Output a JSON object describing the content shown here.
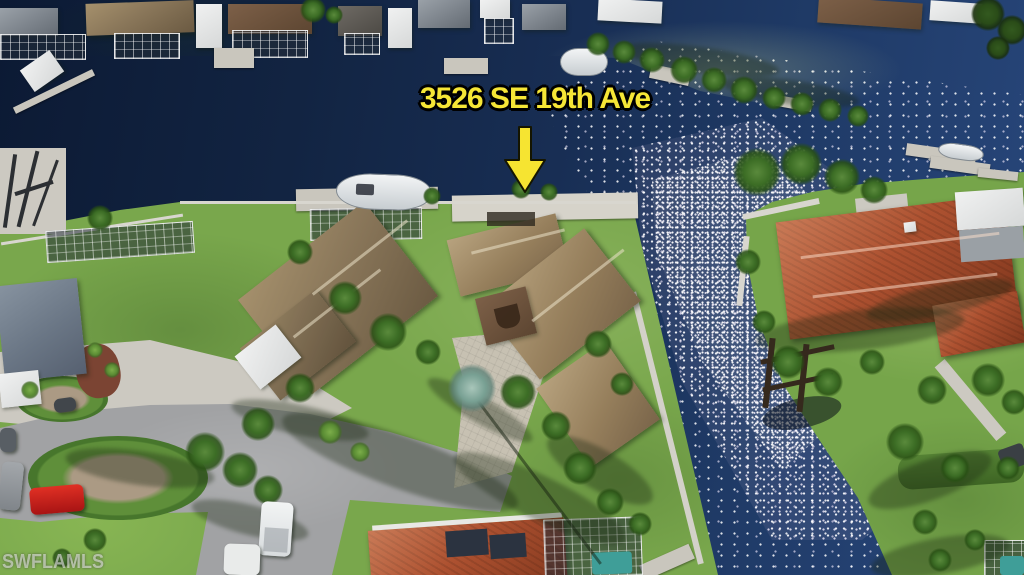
{
  "annotation": {
    "address_label": "3526 SE 19th Ave",
    "label_color": "#f6e636",
    "outline_color": "#000000",
    "arrow_color": "#f6e431"
  },
  "watermark": {
    "text": "SWFLAMLS"
  },
  "scene": {
    "description": "Aerial drone photo of canal-front homes, sun glitter on water",
    "colors": {
      "water_dark": "#0c1a34",
      "water_mid": "#1f3a66",
      "sun_glitter": "#ffffff",
      "grass": "#79a74c",
      "tile_roof_orange": "#ad5130",
      "shingle_roof_brown": "#8a775a",
      "asphalt_street": "#a1a2a4",
      "concrete": "#ccc9c1",
      "red_car": "#c41e1e"
    }
  }
}
